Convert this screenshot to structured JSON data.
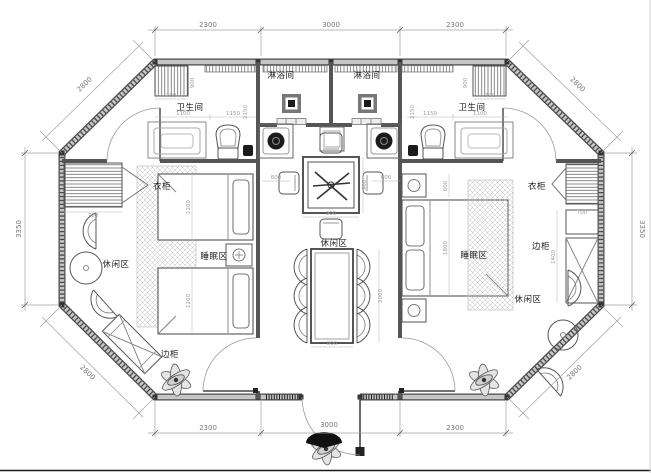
{
  "drawing": {
    "type": "floor-plan",
    "shape": "octagon",
    "colors": {
      "background": "#ffffff",
      "wall_dark": "#4a4a4a",
      "wall_core": "#c6c6c6",
      "line": "#555555",
      "dim": "#8a8a8a",
      "hatch": "#bbbbbb"
    }
  },
  "rooms": [
    {
      "text": "淋浴间"
    },
    {
      "text": "淋浴间"
    },
    {
      "text": "卫生间"
    },
    {
      "text": "卫生间"
    },
    {
      "text": "衣柜"
    },
    {
      "text": "衣柜"
    },
    {
      "text": "休闲区"
    },
    {
      "text": "休闲区"
    },
    {
      "text": "休闲区"
    },
    {
      "text": "睡眠区"
    },
    {
      "text": "睡眠区"
    },
    {
      "text": "边柜"
    },
    {
      "text": "边柜"
    }
  ],
  "dims": {
    "top": [
      "2300",
      "3000",
      "2300"
    ],
    "bottom": [
      "2300",
      "3000",
      "2300"
    ],
    "left": "3350",
    "right": "3350",
    "diagonals": [
      "2800",
      "2800",
      "2800",
      "2800"
    ],
    "minor": [
      "700",
      "900",
      "1100",
      "1150",
      "2150",
      "700",
      "900",
      "1150",
      "1100",
      "2150",
      "600",
      "600",
      "900",
      "900",
      "800",
      "2000",
      "1200",
      "1200",
      "600",
      "1800",
      "1400",
      "700",
      "700"
    ]
  }
}
